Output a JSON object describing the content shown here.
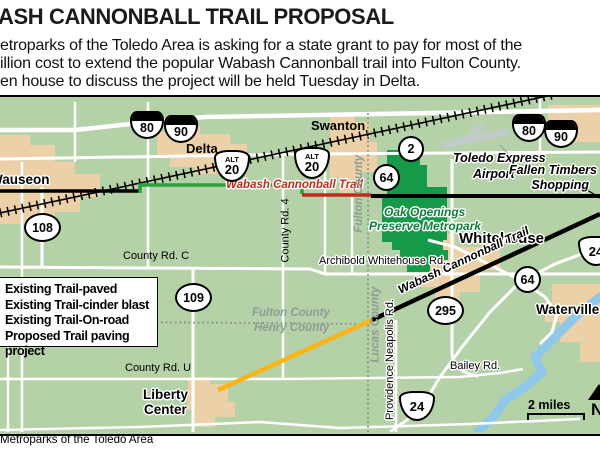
{
  "header": {
    "title": "ASH CANNONBALL TRAIL PROPOSAL",
    "lines": [
      "etroparks of the Toledo Area is asking for a state grant to pay for most of the",
      "illion cost to extend the popular Wabash Cannonball trail into Fulton County.",
      "en house to discuss the project will be held Tuesday in Delta."
    ]
  },
  "legend": {
    "items": [
      "Existing Trail-paved",
      "Existing Trail-cinder blast",
      "Existing Trail-On-road",
      "Proposed Trail paving project"
    ]
  },
  "map": {
    "towns": {
      "wauseon": "Wauseon",
      "delta": "Delta",
      "swanton": "Swanton",
      "whitehouse": "Whitehouse",
      "waterville": "Waterville",
      "liberty_center_1": "Liberty",
      "liberty_center_2": "Center"
    },
    "places": {
      "airport_1": "Toledo Express",
      "airport_2": "Airport",
      "fallen_timbers_1": "Fallen Timbers",
      "fallen_timbers_2": "Shopping",
      "park_1": "Oak Openings",
      "park_2": "Preserve Metropark"
    },
    "trail_labels": {
      "red": "Wabash Cannonball Trail",
      "black": "Wabash Cannonball Trail"
    },
    "roads": {
      "county_rd_c": "County Rd. C",
      "county_rd_4": "County Rd. 4",
      "archibold": "Archibold Whitehouse Rd.",
      "county_rd_u": "County Rd. U",
      "bailey": "Bailey Rd.",
      "providence": "Providence Neapolis Rd."
    },
    "counties": {
      "fulton_v": "Fulton County",
      "lucas_v": "Lucas County",
      "fulton_h": "Fulton County",
      "henry_h": "Henry County"
    },
    "shields": {
      "i80": "80",
      "i90": "90",
      "alt": "ALT",
      "us20": "20",
      "us24": "24",
      "sr2": "2",
      "sr64": "64",
      "sr108": "108",
      "sr109": "109",
      "sr295": "295"
    },
    "scale_label": "2 miles",
    "north_label": "N",
    "colors": {
      "land": "#b5d1a8",
      "urban": "#ecd0a8",
      "park": "#149a48",
      "road": "#ffffff",
      "river": "#8fc8e9",
      "trail_paved": "#2aa13b",
      "trail_cinder": "#c02b1c",
      "trail_onroad": "#000000",
      "trail_proposed": "#fbb316",
      "county_line": "#808f8a"
    }
  },
  "credit": "Metroparks of the Toledo Area"
}
